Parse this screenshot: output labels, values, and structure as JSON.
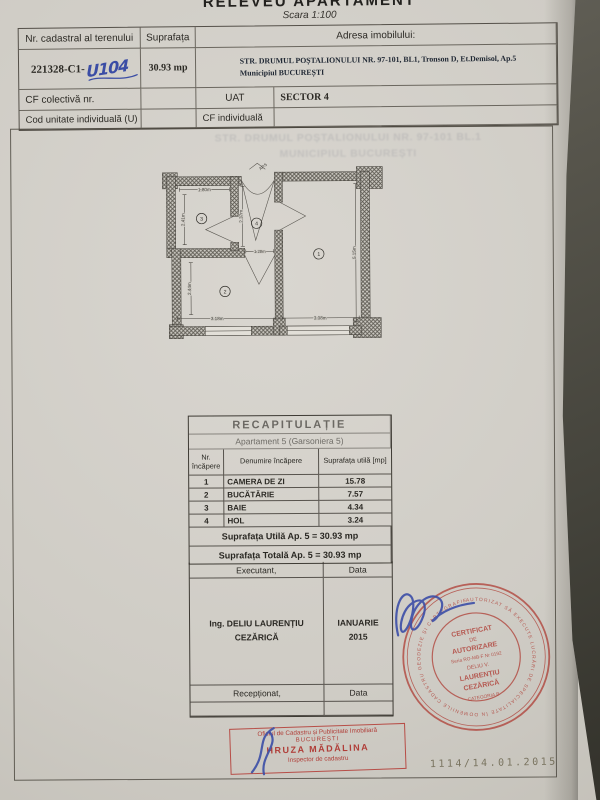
{
  "header": {
    "title": "RELEVEU APARTAMENT",
    "scale": "Scara 1:100",
    "table": {
      "col1_label": "Nr. cadastral al terenului",
      "col2_label": "Suprafața",
      "address_label": "Adresa imobilului:",
      "cadastral_printed": "221328-C1-",
      "cadastral_handwritten": "U104",
      "area_value": "30.93 mp",
      "address_line1": "STR. DRUMUL POȘTALIONULUI NR. 97-101, BL1, Tronson D, Et.Demisol, Ap.5",
      "address_line2": "Municipiul BUCUREȘTI",
      "cf_colectiva_label": "CF colectivă nr.",
      "uat_label": "UAT",
      "uat_value": "SECTOR 4",
      "cod_unitate_label": "Cod unitate individuală (U)",
      "cf_individuala_label": "CF individuală"
    }
  },
  "bleed_text": {
    "line1": "STR. DRUMUL POȘTALIONULUI NR. 97-101 BL.1",
    "line2": "MUNICIPIUL BUCUREȘTI"
  },
  "floor_plan": {
    "entrance_label": "AP.5",
    "dims": {
      "baie_w": "1.80m",
      "baie_h": "2.41m",
      "hol_h": "2.37m",
      "hol_w": "1.28m",
      "living_w": "3.08m",
      "living_h": "5.15m",
      "kitchen_w": "3.18m",
      "kitchen_h": "2.44m"
    },
    "room_numbers": {
      "living": "1",
      "kitchen": "2",
      "baie": "3",
      "hol": "4"
    }
  },
  "recap_table": {
    "title": "RECAPITULAȚIE",
    "subtitle": "Apartament 5 (Garsoniera 5)",
    "headers": {
      "col1": "Nr. încăpere",
      "col2": "Denumire încăpere",
      "col3": "Suprafața utilă [mp]"
    },
    "rows": [
      {
        "nr": "1",
        "name": "CAMERA DE ZI",
        "area": "15.78"
      },
      {
        "nr": "2",
        "name": "BUCĂTĂRIE",
        "area": "7.57"
      },
      {
        "nr": "3",
        "name": "BAIE",
        "area": "4.34"
      },
      {
        "nr": "4",
        "name": "HOL",
        "area": "3.24"
      }
    ],
    "total_util": "Suprafața Utilă Ap. 5 = 30.93 mp",
    "total_total": "Suprafața Totală Ap. 5 = 30.93 mp"
  },
  "signature_block": {
    "executant_label": "Executant,",
    "data_label": "Data",
    "executant_name": "Ing. DELIU LAURENȚIU CEZĂRICĂ",
    "date_value": "IANUARIE 2015",
    "receptionat_label": "Recepționat,",
    "data_label2": "Data"
  },
  "round_stamp": {
    "ring_text": "AUTORIZAT SĂ EXECUTE LUCRĂRI DE SPECIALITATE ÎN DOMENIILE CADASTRU GEODEZIE ȘI CARTOGRAFIE",
    "line1": "CERTIFICAT",
    "line2": "DE",
    "line3": "AUTORIZARE",
    "line4": "Seria RO-MB-F Nr 0192",
    "line5": "DELIU V.",
    "line6": "LAURENȚIU",
    "line7": "CEZĂRICĂ",
    "line8": "CATEGORIA B"
  },
  "rect_stamp": {
    "line1": "Oficiul de Cadastru și Publicitate Imobiliară",
    "line2": "BUCUREȘTI",
    "line3": "HRUZA MĂDĂLINA",
    "line4": "Inspector de cadastru"
  },
  "registration_number": "1114/14.01.2015",
  "colors": {
    "stamp_red": "#ab2e26",
    "ink_blue": "#3b4ea6",
    "paper": "#cfccc5"
  }
}
